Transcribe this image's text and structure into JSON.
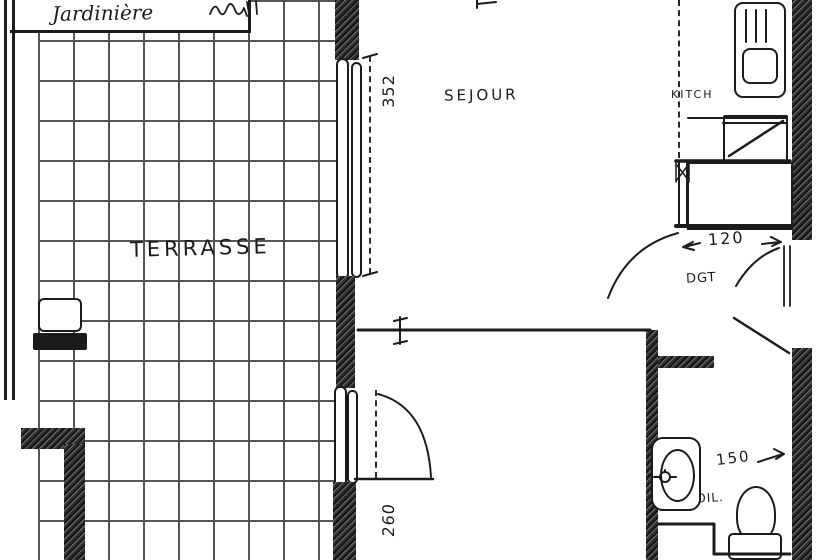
{
  "colors": {
    "ink": "#1b1b1b",
    "wall_fill": "#4f4f4f",
    "paper": "#ffffff"
  },
  "plan": {
    "terrace": {
      "label": "TERRASSE"
    },
    "planter": {
      "label": "Jardinière"
    },
    "living": {
      "label": "SEJOUR"
    },
    "kitchen": {
      "label": "KITCH"
    },
    "closet": {
      "label": "PL"
    },
    "hallway": {
      "label": "DGT"
    },
    "toilet": {
      "label": "TOIL."
    },
    "dims": {
      "terrace_window": "352",
      "terrace_door": "260",
      "hallway_width": "120",
      "toilet_width": "150"
    }
  }
}
